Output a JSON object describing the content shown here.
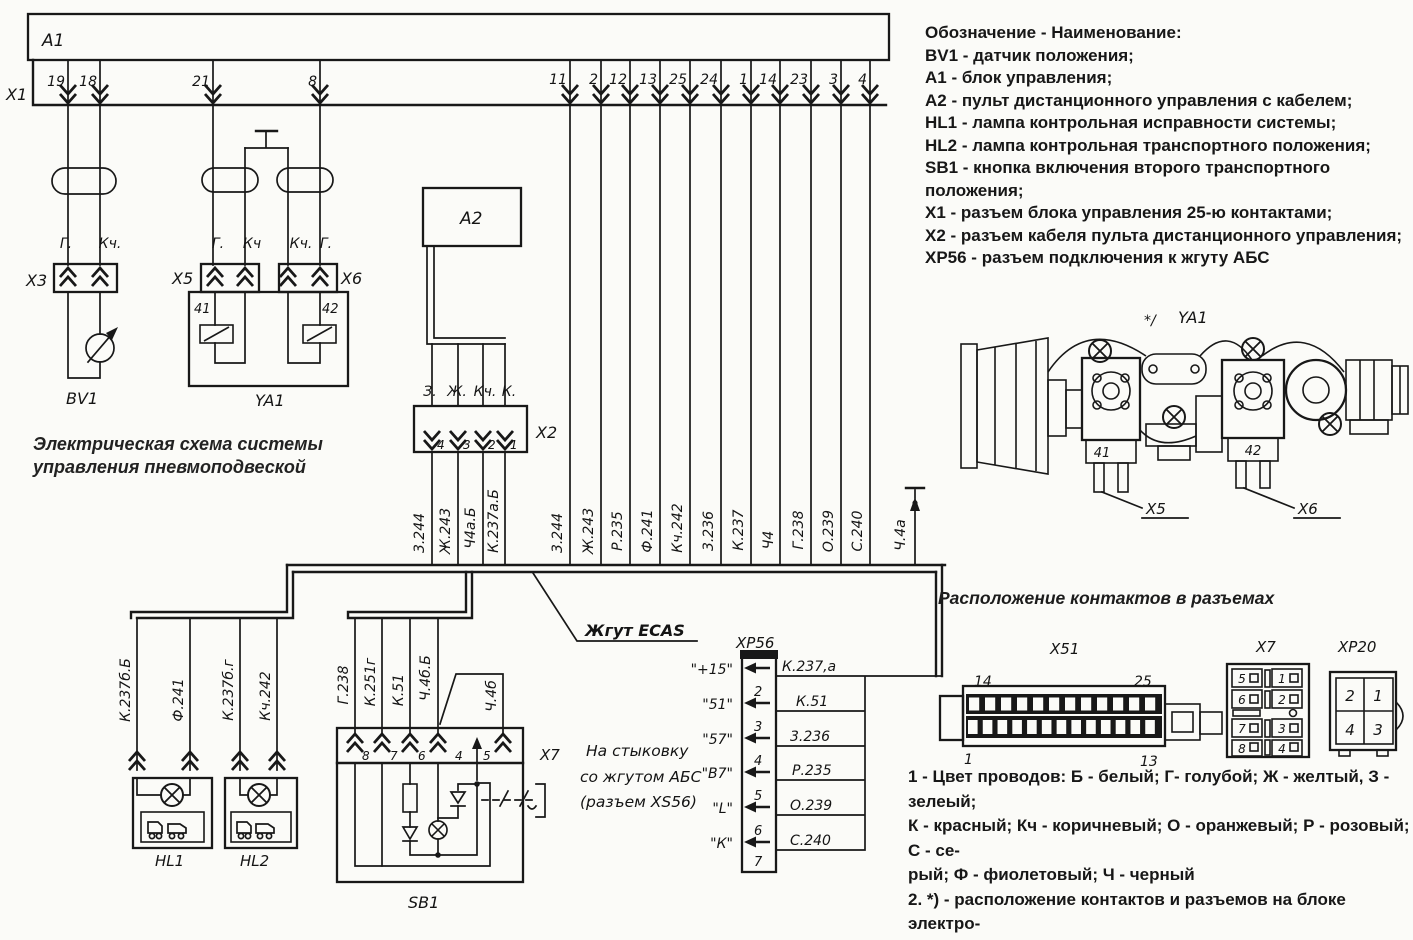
{
  "caption": [
    "Электрическая схема системы",
    "управления пневмоподвеской"
  ],
  "legend": {
    "heading": "Обозначение - Наименование:",
    "items": [
      "BV1 - датчик положения;",
      "А1 - блок управления;",
      "А2 - пульт дистанционного управления с кабелем;",
      "HL1 - лампа контрольная исправности системы;",
      "HL2 - лампа контрольная транспортного положения;",
      "SB1 - кнопка включения второго транспортного положения;",
      "Х1 - разъем блока управления 25-ю контактами;",
      "Х2 - разъем кабеля пульта дистанционного управления;",
      "ХР56 - разъем подключения к жгуту АБС"
    ]
  },
  "notes": [
    "1 - Цвет проводов: Б - белый; Г- голубой; Ж - желтый, З - зелеый;",
    "К - красный; Кч - коричневый; О - оранжевый; Р - розовый; С - се-",
    "рый; Ф - фиолетовый; Ч - черный",
    "2. *) - расположение контактов и разъемов на блоке электро-",
    "пневмоклапанов",
    "3. Вид на разьемы дан со стороны установки проводов"
  ],
  "labels": {
    "a1": "А1",
    "x1": "Х1",
    "x3": "Х3",
    "x5": "Х5",
    "x6": "Х6",
    "bv1": "BV1",
    "ya1": "YA1",
    "a2": "А2",
    "x2": "Х2",
    "sb1": "SB1",
    "hl1": "HL1",
    "hl2": "HL2",
    "x7_ref": "Х7",
    "xp56": "ХР56",
    "sol41": "41",
    "sol42": "42",
    "ecas": "Жгут ECAS",
    "ground_wire": "Ч.4а"
  },
  "x1_pins": [
    "19",
    "18",
    "21",
    "8",
    "11",
    "2",
    "12",
    "13",
    "25",
    "24",
    "1",
    "14",
    "23",
    "3",
    "4"
  ],
  "x3_wire_colors": [
    "Г.",
    "Кч."
  ],
  "x5_wire_colors": [
    "Г.",
    "Кч"
  ],
  "x6_wire_colors": [
    "Кч.",
    "Г."
  ],
  "x2_wire_colors": [
    "З.",
    "Ж.",
    "Кч.",
    "К."
  ],
  "x2_pins": [
    "4",
    "3",
    "2",
    "1"
  ],
  "a2_branch_wires": [
    "3.244",
    "Ж.243",
    "Ч4а.Б",
    "К.237а.Б"
  ],
  "main_wires": [
    "3.244",
    "Ж.243",
    "Р.235",
    "Ф.241",
    "Кч.242",
    "3.236",
    "К.237",
    "Ч4",
    "Г.238",
    "О.239",
    "С.240"
  ],
  "hl_wires": [
    "К.237б.Б",
    "Ф.241",
    "К.237б.г",
    "Кч.242"
  ],
  "sb1_wires": [
    "Г.238",
    "К.251г",
    "К.51",
    "Ч.4б.Б",
    "Ч.4б"
  ],
  "sb1_pins": [
    "8",
    "7",
    "6",
    "4",
    "5"
  ],
  "abs_note": [
    "На стыковку",
    "со жгутом АБС",
    "(разъем ХS56)"
  ],
  "xp56": {
    "signals": [
      "\"+15\"",
      "\"51\"",
      "\"57\"",
      "\"В7\"",
      "\"L\"",
      "\"К\""
    ],
    "pins": [
      "2",
      "3",
      "4",
      "5",
      "6",
      "7"
    ],
    "wires": [
      "К.237,а",
      "К.51",
      "3.236",
      "Р.235",
      "О.239",
      "С.240"
    ]
  },
  "contacts": {
    "heading": "Расположение контактов в разъемах",
    "x51": {
      "label": "Х51",
      "tl": "14",
      "tr": "25",
      "bl": "1",
      "br": "13"
    },
    "x7": {
      "label": "Х7",
      "cells": [
        "5",
        "1",
        "6",
        "2",
        "7",
        "3",
        "8",
        "4"
      ]
    },
    "xp20": {
      "label": "ХР20",
      "cells": [
        "2",
        "1",
        "4",
        "3"
      ]
    }
  },
  "illustration": {
    "star": "*/",
    "ya1": "YA1",
    "x5": "Х5",
    "x6": "Х6",
    "sol41": "41",
    "sol42": "42"
  }
}
